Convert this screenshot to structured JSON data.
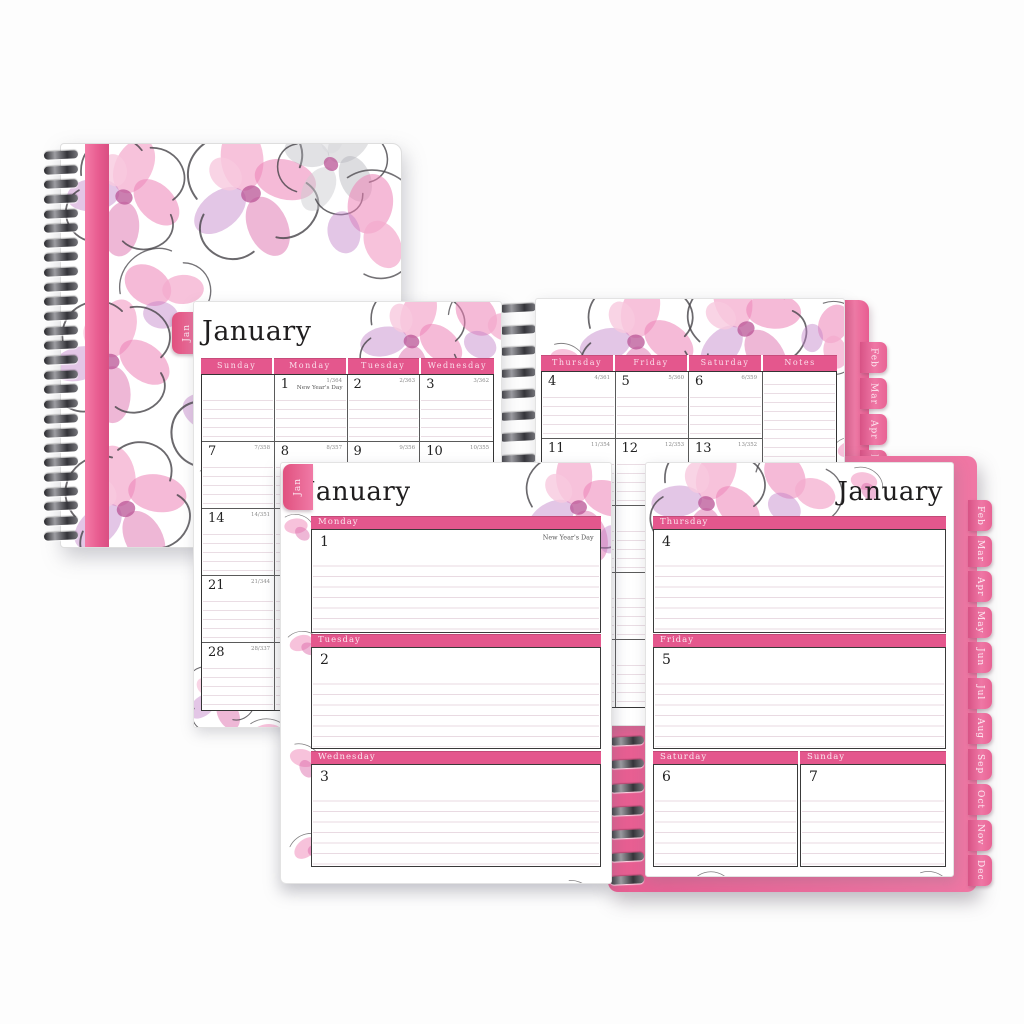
{
  "colors": {
    "accent_pink": "#e9558a",
    "bar_pink": "#e4578d",
    "tab_pink": "#ee76a3",
    "stripe_pink": "#ec6292",
    "flower_pink": "#f2a9c9",
    "flower_purple": "#bb84c4"
  },
  "monthly": {
    "tab_label": "Jan",
    "title": "January",
    "left_day_headers": [
      "Sunday",
      "Monday",
      "Tuesday",
      "Wednesday"
    ],
    "right_day_headers": [
      "Thursday",
      "Friday",
      "Saturday"
    ],
    "notes_header": "Notes",
    "side_tabs": [
      "Feb",
      "Mar",
      "Apr",
      "May"
    ],
    "left_weeks": [
      [
        {
          "date": "",
          "code": ""
        },
        {
          "date": "1",
          "code": "1/364",
          "note": "New Year's Day"
        },
        {
          "date": "2",
          "code": "2/363"
        },
        {
          "date": "3",
          "code": "3/362"
        }
      ],
      [
        {
          "date": "7",
          "code": "7/358"
        },
        {
          "date": "8",
          "code": "8/357"
        },
        {
          "date": "9",
          "code": "9/356"
        },
        {
          "date": "10",
          "code": "10/355"
        }
      ],
      [
        {
          "date": "14",
          "code": "14/351"
        },
        {
          "date": "15",
          "code": "15/350"
        },
        {
          "date": ""
        },
        {
          "date": ""
        }
      ],
      [
        {
          "date": "21",
          "code": "21/344"
        },
        {
          "date": "22",
          "code": "22/343"
        },
        {
          "date": ""
        },
        {
          "date": ""
        }
      ],
      [
        {
          "date": "28",
          "code": "28/337"
        },
        {
          "date": "29",
          "code": "29/336"
        },
        {
          "date": ""
        },
        {
          "date": ""
        }
      ]
    ],
    "right_weeks": [
      [
        {
          "date": "4",
          "code": "4/361"
        },
        {
          "date": "5",
          "code": "5/360"
        },
        {
          "date": "6",
          "code": "6/359"
        }
      ],
      [
        {
          "date": "11",
          "code": "11/354"
        },
        {
          "date": "12",
          "code": "12/353"
        },
        {
          "date": "13",
          "code": "13/352"
        }
      ],
      [
        {
          "date": ""
        },
        {
          "date": ""
        },
        {
          "date": ""
        }
      ],
      [
        {
          "date": ""
        },
        {
          "date": ""
        },
        {
          "date": ""
        }
      ],
      [
        {
          "date": ""
        },
        {
          "date": ""
        },
        {
          "date": ""
        }
      ]
    ]
  },
  "weekly": {
    "tab_label": "Jan",
    "left_title": "January",
    "right_title": "January",
    "left_sections": [
      {
        "label": "Monday",
        "date": "1",
        "note": "New Year's Day"
      },
      {
        "label": "Tuesday",
        "date": "2",
        "note": ""
      },
      {
        "label": "Wednesday",
        "date": "3",
        "note": ""
      }
    ],
    "right_sections": [
      {
        "label": "Thursday",
        "date": "4",
        "note": ""
      },
      {
        "label": "Friday",
        "date": "5",
        "note": ""
      }
    ],
    "split_sections": [
      {
        "label": "Saturday",
        "date": "6"
      },
      {
        "label": "Sunday",
        "date": "7"
      }
    ],
    "side_tabs": [
      "Feb",
      "Mar",
      "Apr",
      "May",
      "Jun",
      "Jul",
      "Aug",
      "Sep",
      "Oct",
      "Nov",
      "Dec"
    ]
  }
}
